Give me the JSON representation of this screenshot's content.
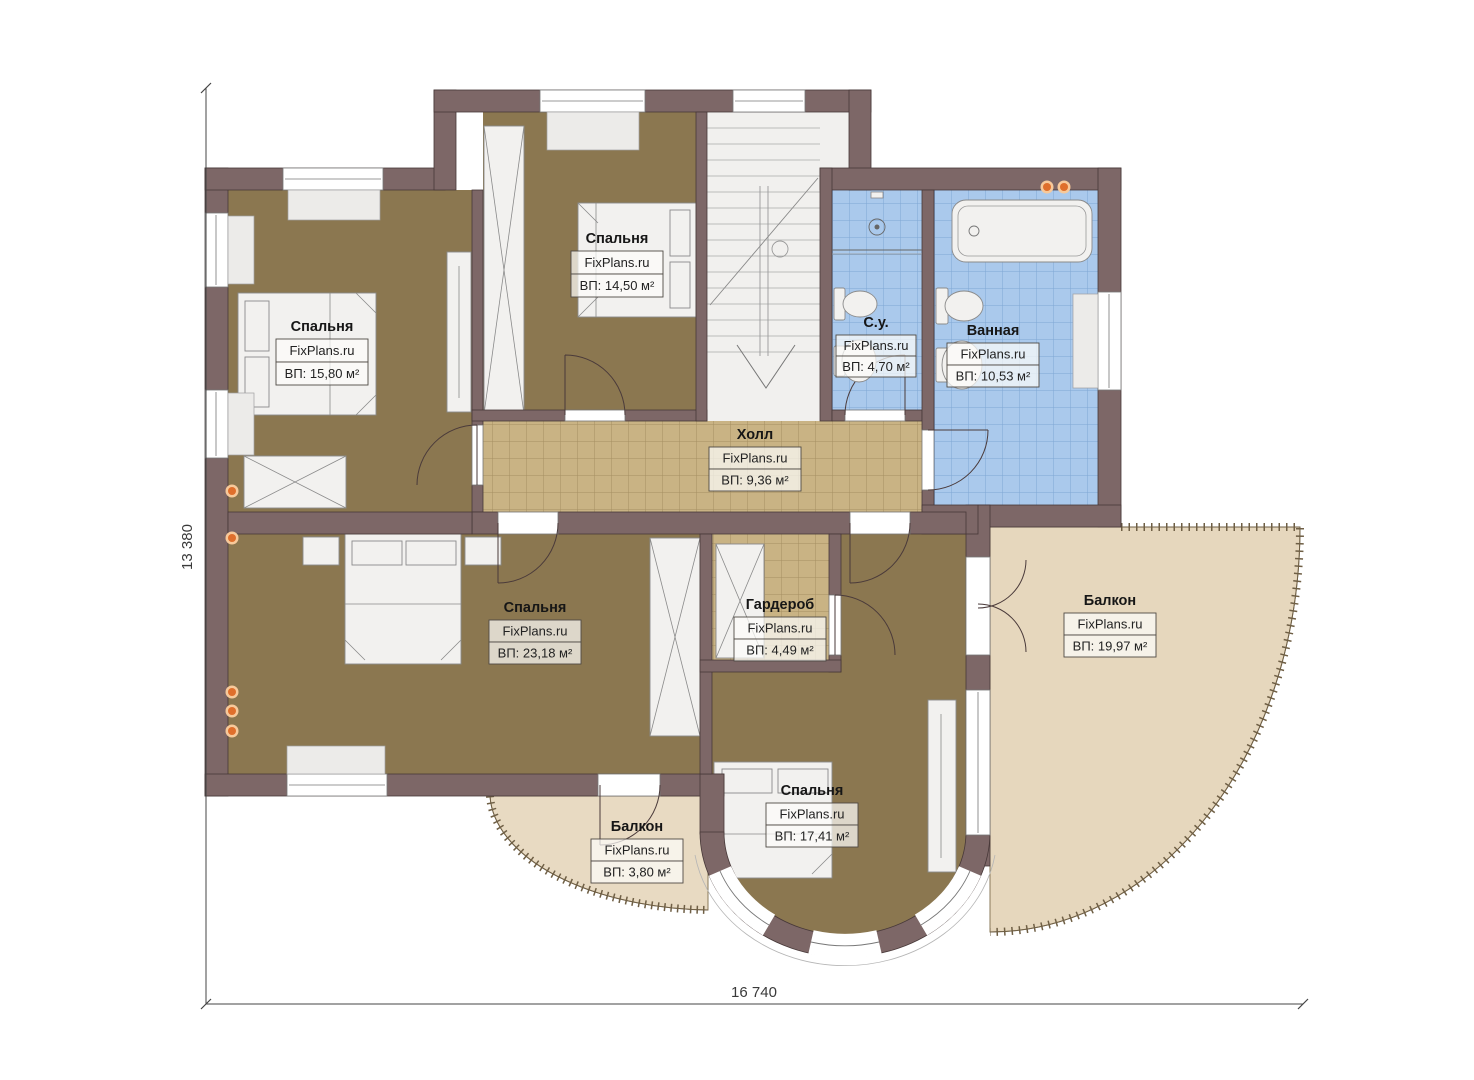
{
  "watermark": "FixPlans.ru",
  "dimensions": {
    "height_label": "13 380",
    "width_label": "16 740"
  },
  "rooms": {
    "bedroom1": {
      "name": "Спальня",
      "area": "ВП: 15,80 м²"
    },
    "bedroom2": {
      "name": "Спальня",
      "area": "ВП: 14,50 м²"
    },
    "wc": {
      "name": "С.у.",
      "area": "ВП: 4,70 м²"
    },
    "bath": {
      "name": "Ванная",
      "area": "ВП: 10,53 м²"
    },
    "hall": {
      "name": "Холл",
      "area": "ВП: 9,36 м²"
    },
    "bedroom3": {
      "name": "Спальня",
      "area": "ВП: 23,18 м²"
    },
    "wardrobe": {
      "name": "Гардероб",
      "area": "ВП: 4,49 м²"
    },
    "balconyRight": {
      "name": "Балкон",
      "area": "ВП: 19,97 м²"
    },
    "balconyLeft": {
      "name": "Балкон",
      "area": "ВП: 3,80 м²"
    },
    "bedroom4": {
      "name": "Спальня",
      "area": "ВП: 17,41 м²"
    }
  },
  "colors": {
    "wall": "#7d6767",
    "bedroom_floor": "#8b7750",
    "tile_floor": "#c9b384",
    "bath_tile": "#aac9ec",
    "balcony_floor": "#e7d9c1",
    "light_dot": "#df6f2c"
  }
}
